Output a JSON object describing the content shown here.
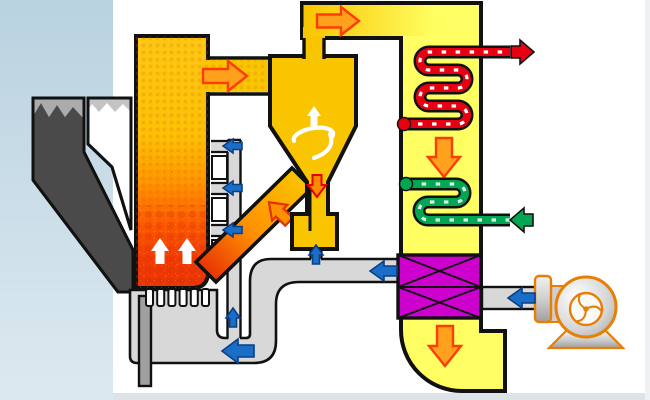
{
  "diagram": {
    "type": "process-flow-schematic",
    "subject": "circulating-fluidized-bed-boiler",
    "components": [
      {
        "id": "coal-hopper",
        "kind": "fuel-bin",
        "fill": "dark-gray"
      },
      {
        "id": "limestone-hopper",
        "kind": "sorbent-bin",
        "fill": "white"
      },
      {
        "id": "furnace",
        "kind": "combustion-chamber",
        "gradient": [
          "#fdc713",
          "#ff9400",
          "#e83305"
        ]
      },
      {
        "id": "grate-nozzles",
        "kind": "air-distributor"
      },
      {
        "id": "ash-drain-pipe",
        "kind": "drain"
      },
      {
        "id": "cyclone-separator",
        "kind": "particle-separator",
        "internal": "swirl-icon"
      },
      {
        "id": "loop-seal",
        "kind": "solids-return"
      },
      {
        "id": "solids-return-leg",
        "kind": "duct",
        "gradient": [
          "#f9c400",
          "#e83305"
        ]
      },
      {
        "id": "crossover-duct",
        "kind": "gas-duct"
      },
      {
        "id": "backpass-channel",
        "kind": "convective-pass"
      },
      {
        "id": "superheater-coil",
        "kind": "serpentine-tube",
        "color": "#e60012"
      },
      {
        "id": "economizer-coil",
        "kind": "serpentine-tube",
        "color": "#00a651"
      },
      {
        "id": "air-preheater",
        "kind": "heat-exchanger-matrix",
        "color": "#cd00cd",
        "cells": 2
      },
      {
        "id": "air-duct-network",
        "kind": "air-ducting",
        "color": "#d8d8d8"
      },
      {
        "id": "secondary-air-ports",
        "kind": "air-injection",
        "count": 3
      },
      {
        "id": "fan",
        "kind": "centrifugal-blower",
        "outline": "#e87e04"
      }
    ],
    "flows": [
      {
        "id": "gas-to-cyclone-arrow",
        "color": "orange",
        "direction": "right"
      },
      {
        "id": "gas-to-backpass-arrow",
        "color": "orange",
        "direction": "right"
      },
      {
        "id": "flue-gas-down-arrow-1",
        "color": "orange",
        "direction": "down"
      },
      {
        "id": "flue-gas-down-arrow-2",
        "color": "orange",
        "direction": "down"
      },
      {
        "id": "solids-down-arrow",
        "color": "orange-red",
        "direction": "down"
      },
      {
        "id": "solids-return-arrow",
        "color": "orange",
        "direction": "down-left"
      },
      {
        "id": "steam-out-arrow",
        "color": "red",
        "direction": "right"
      },
      {
        "id": "water-in-arrow",
        "color": "green",
        "direction": "left"
      },
      {
        "id": "fan-air-arrow",
        "color": "blue",
        "direction": "left"
      },
      {
        "id": "preheated-air-arrow",
        "color": "blue",
        "direction": "left"
      },
      {
        "id": "primary-air-arrow",
        "color": "blue",
        "direction": "left"
      },
      {
        "id": "secondary-air-arrows",
        "color": "blue",
        "direction": "left",
        "count": 3
      },
      {
        "id": "riser-air-arrow",
        "color": "blue",
        "direction": "up"
      },
      {
        "id": "loopseal-air-arrow",
        "color": "blue",
        "direction": "up"
      },
      {
        "id": "bed-up-arrows",
        "color": "white",
        "direction": "up",
        "count": 2
      },
      {
        "id": "cyclone-up-arrow",
        "color": "white",
        "direction": "up"
      }
    ]
  },
  "colors": {
    "background": "#ffffff",
    "side_band_top": "#b9d2e0",
    "side_band_bottom": "#dde9f0",
    "bottom_strip": "#dce4ea",
    "gold": "#f9c400",
    "flue_yellow": "#ffff63",
    "magenta": "#cd00cd",
    "duct_gray": "#d8d8d8",
    "steam_red": "#e60012",
    "water_green": "#00a651",
    "air_blue": "#1b6ec8",
    "air_blue_dark": "#0b3f85",
    "gas_orange": "#ffa11d",
    "gas_orange_edge": "#ff3c00",
    "fan_orange": "#e87e04",
    "outline_black": "#111111",
    "coal_dark": "#4a4a4a",
    "coal_band": "#ababab",
    "limestone_band": "#c4c4c4",
    "ash_gray": "#a0a0a0"
  }
}
